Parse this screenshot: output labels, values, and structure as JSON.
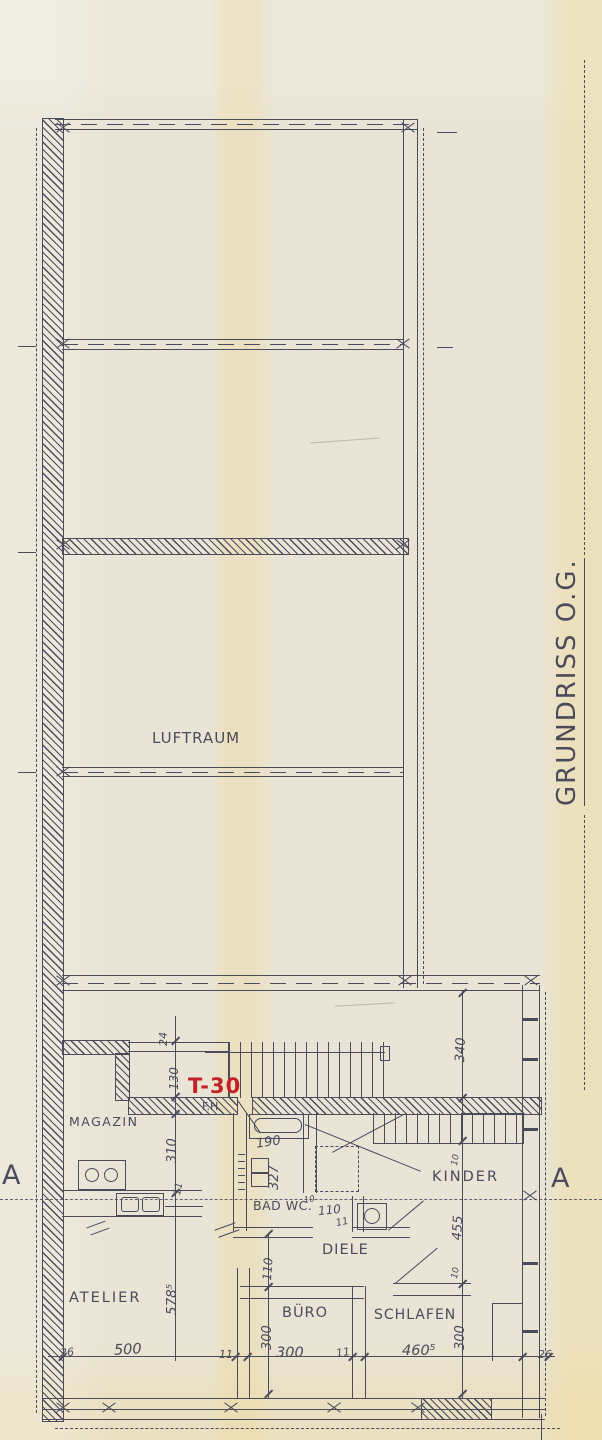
{
  "title": {
    "drawing_title": "GRUNDRISS O.G."
  },
  "labels": {
    "luftraum": "LUFTRAUM",
    "magazin": "MAGAZIN",
    "atelier": "ATELIER",
    "buero": "BÜRO",
    "schlafen": "SCHLAFEN",
    "diele": "DIELE",
    "bad_wc": "BAD WC.",
    "kinder": "KINDER",
    "fire_door": "T-30",
    "fh": "F.H.",
    "section_a_left": "A",
    "section_a_right": "A"
  },
  "dims": {
    "d26_left": "26",
    "d500": "500",
    "d11_a": "11",
    "d300_h": "300",
    "d11_b": "11",
    "d460_5": "460⁵",
    "d26_right": "26",
    "d300_v_left": "300",
    "d110_v": "110",
    "d300_v_right": "300",
    "d455": "455",
    "d10_a": "10",
    "d10_b": "10",
    "d10_wc": "10",
    "d340": "340",
    "d310": "310",
    "d578_5": "578⁵",
    "d24": "24",
    "d130": "130",
    "d190": "190",
    "d327": "327",
    "d110_bad": "110",
    "d11_c": "11",
    "d11_d": "11"
  },
  "colors": {
    "paper": "#e9e4d5",
    "ink": "#4b4b5c",
    "stamp_red": "#c32127"
  }
}
